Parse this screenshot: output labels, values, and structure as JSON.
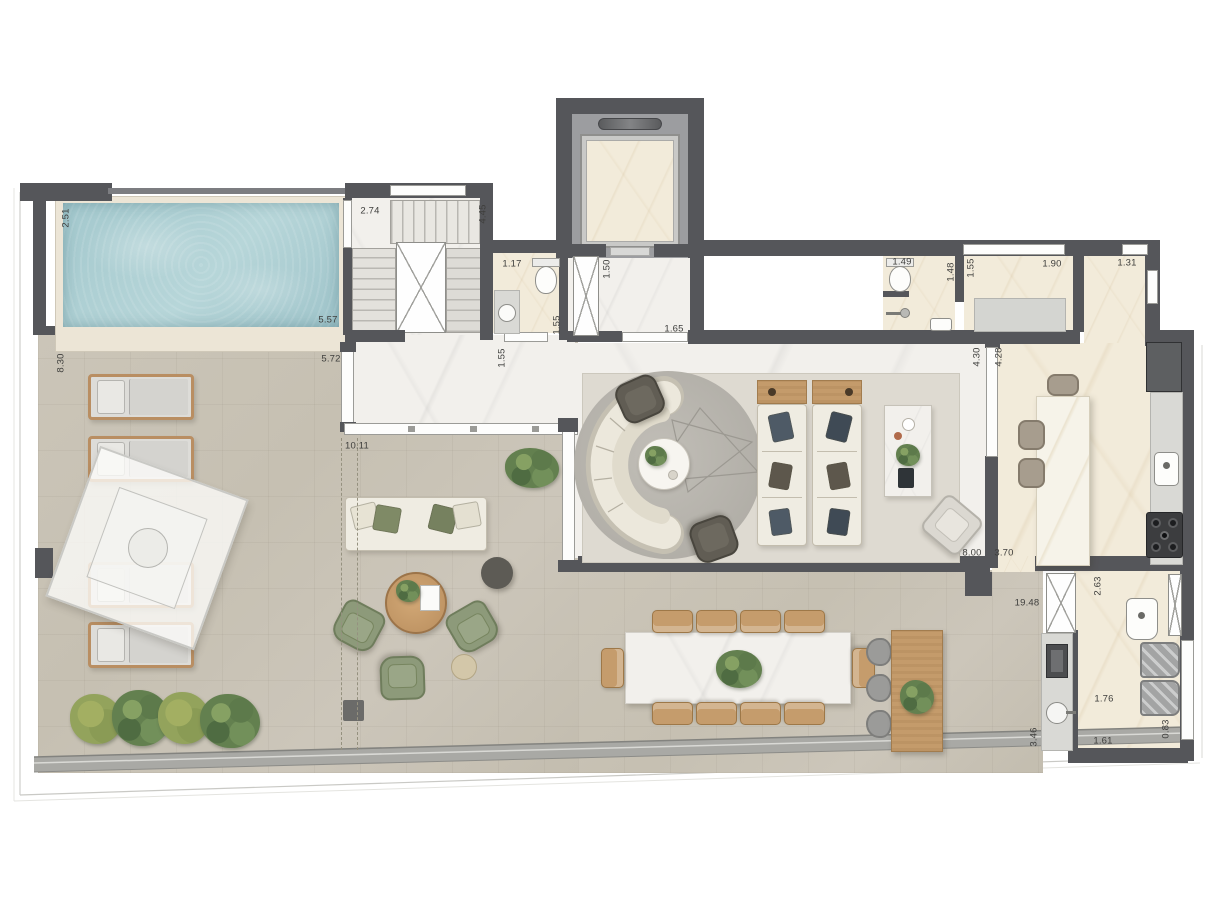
{
  "meta": {
    "type": "architectural-floor-plan",
    "canvas": {
      "width": 1213,
      "height": 913
    }
  },
  "colors": {
    "wall": "#55565a",
    "terrace_floor": "#c8c2b5",
    "interior_marble": "#f2f0ec",
    "cream_marble": "#f2ebda",
    "pool_water": "#aacdd2",
    "wood": "#c49b6b",
    "plant_green": "#63804f",
    "armchair_green": "#8d9a7a",
    "parapet": "#a9a9a5"
  },
  "dimension_labels": [
    {
      "text": "2.51",
      "x": 66,
      "y": 218,
      "dir": "v"
    },
    {
      "text": "5.57",
      "x": 328,
      "y": 320,
      "dir": "h"
    },
    {
      "text": "2.74",
      "x": 370,
      "y": 211,
      "dir": "h"
    },
    {
      "text": "4.45",
      "x": 483,
      "y": 214,
      "dir": "v"
    },
    {
      "text": "1.17",
      "x": 512,
      "y": 264,
      "dir": "h"
    },
    {
      "text": "1.50",
      "x": 607,
      "y": 269,
      "dir": "v"
    },
    {
      "text": "1.55",
      "x": 557,
      "y": 325,
      "dir": "v"
    },
    {
      "text": "1.65",
      "x": 674,
      "y": 329,
      "dir": "h"
    },
    {
      "text": "1.55",
      "x": 502,
      "y": 358,
      "dir": "v"
    },
    {
      "text": "1.49",
      "x": 902,
      "y": 262,
      "dir": "h"
    },
    {
      "text": "1.48",
      "x": 951,
      "y": 272,
      "dir": "v"
    },
    {
      "text": "1.55",
      "x": 971,
      "y": 268,
      "dir": "v"
    },
    {
      "text": "1.90",
      "x": 1052,
      "y": 264,
      "dir": "h"
    },
    {
      "text": "1.31",
      "x": 1127,
      "y": 263,
      "dir": "h"
    },
    {
      "text": "8.30",
      "x": 61,
      "y": 363,
      "dir": "v"
    },
    {
      "text": "5.72",
      "x": 331,
      "y": 359,
      "dir": "h"
    },
    {
      "text": "10.11",
      "x": 357,
      "y": 446,
      "dir": "h"
    },
    {
      "text": "4.30",
      "x": 977,
      "y": 357,
      "dir": "v"
    },
    {
      "text": "4.28",
      "x": 999,
      "y": 357,
      "dir": "v"
    },
    {
      "text": "8.00",
      "x": 972,
      "y": 553,
      "dir": "h"
    },
    {
      "text": "3.70",
      "x": 1004,
      "y": 553,
      "dir": "h"
    },
    {
      "text": "19.48",
      "x": 1027,
      "y": 603,
      "dir": "h"
    },
    {
      "text": "2.63",
      "x": 1098,
      "y": 586,
      "dir": "v"
    },
    {
      "text": "1.76",
      "x": 1104,
      "y": 699,
      "dir": "h"
    },
    {
      "text": "1.61",
      "x": 1103,
      "y": 741,
      "dir": "h"
    },
    {
      "text": "3.46",
      "x": 1034,
      "y": 737,
      "dir": "v"
    },
    {
      "text": "0.83",
      "x": 1166,
      "y": 729,
      "dir": "v"
    }
  ]
}
